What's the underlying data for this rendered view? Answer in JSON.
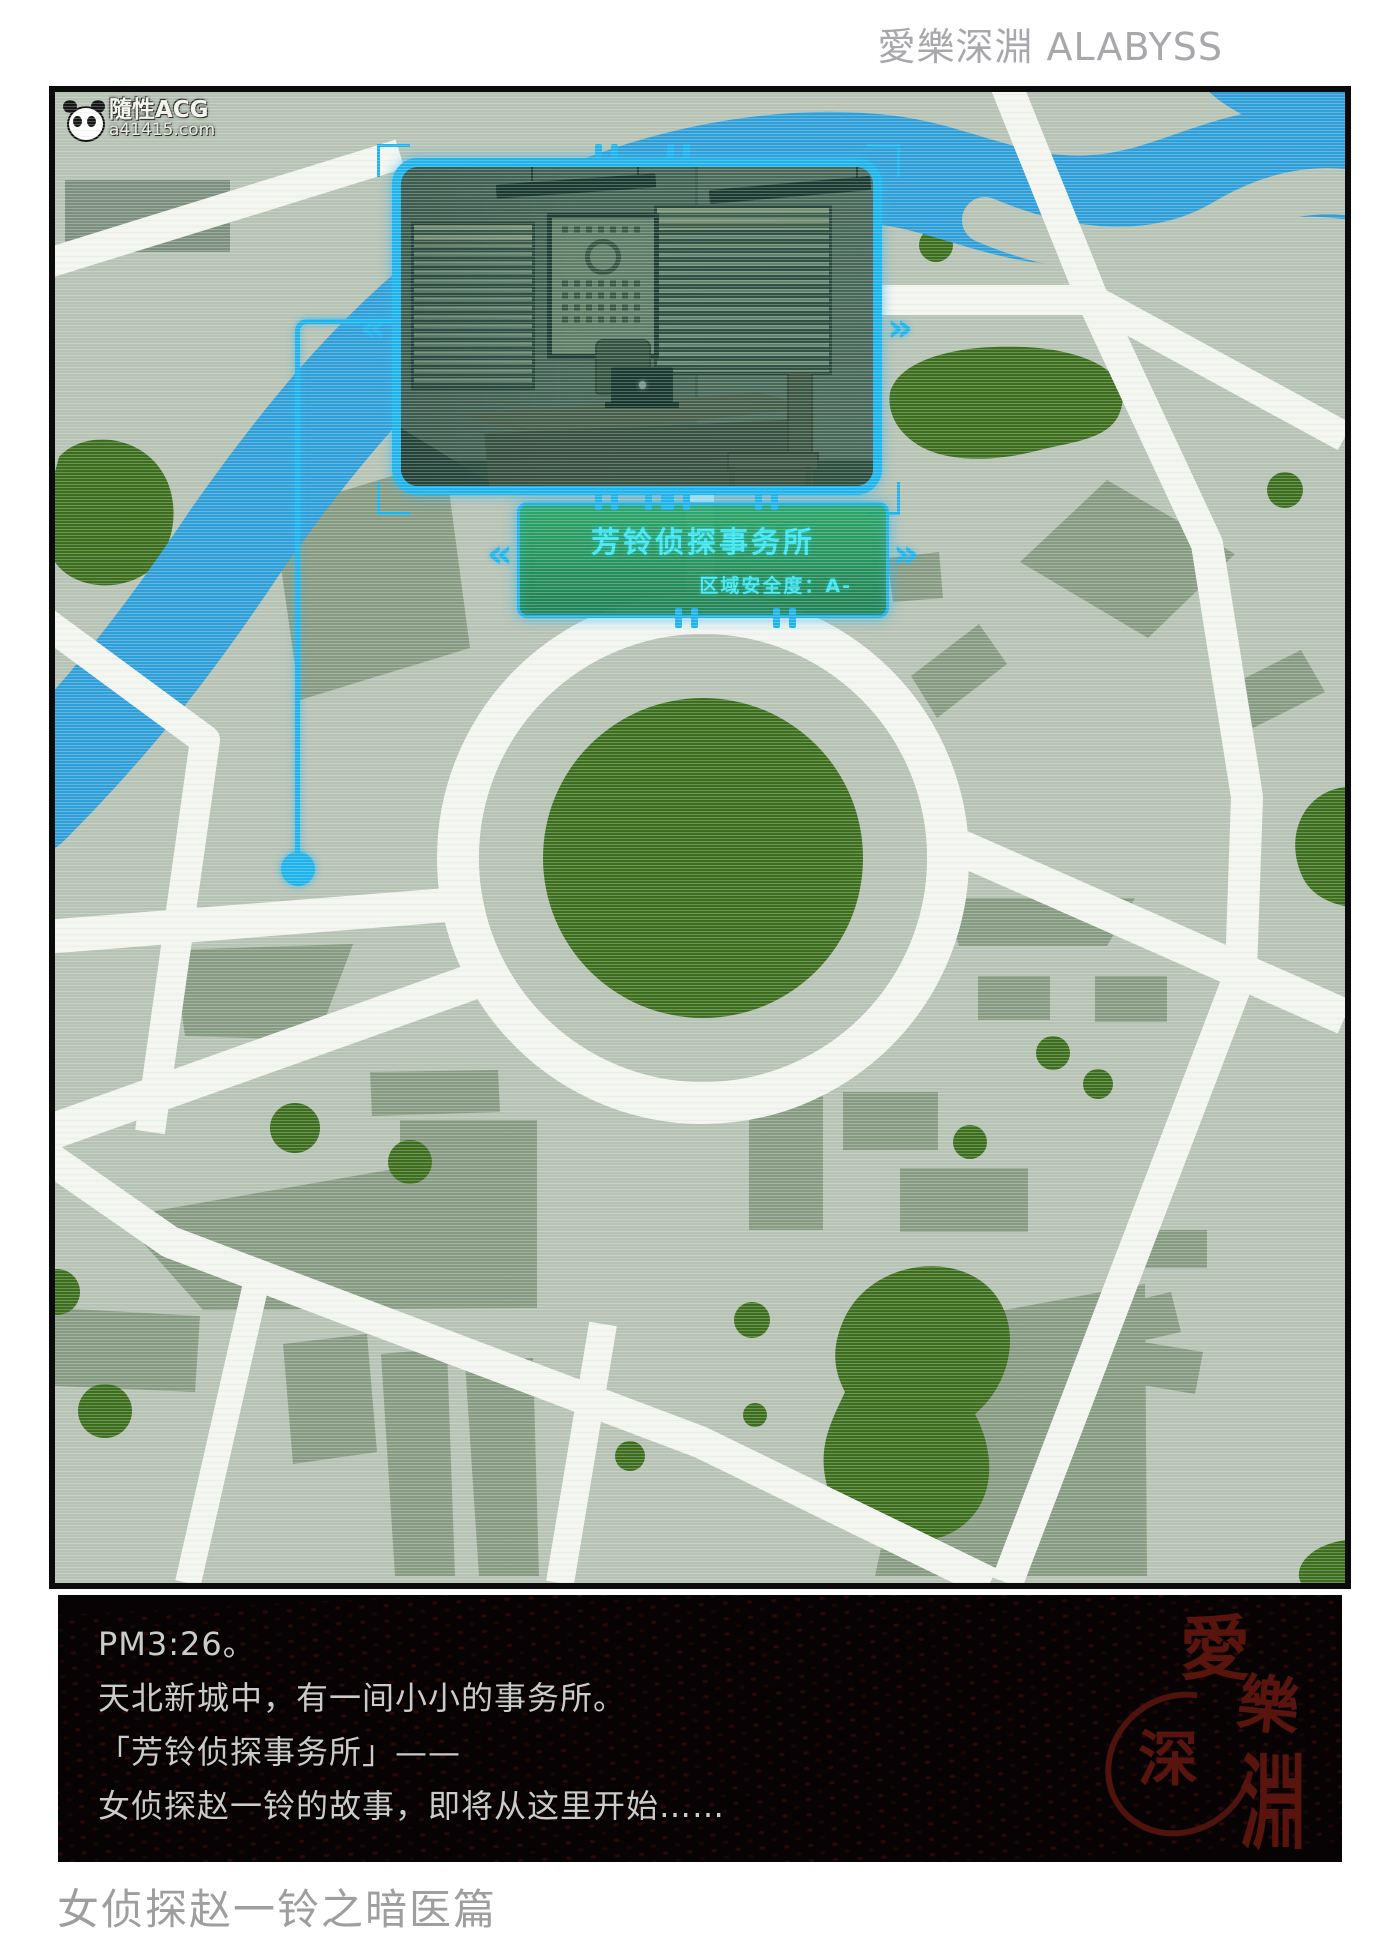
{
  "header": {
    "brand": "愛樂深淵 ALABYSS"
  },
  "watermark": {
    "site_name": "隨性ACG",
    "site_url": "a41415.com"
  },
  "map": {
    "callout": {
      "title": "芳铃侦探事务所",
      "safety_label": "区域安全度：A-"
    },
    "marker": {
      "shape": "circle",
      "color": "#1db4ee"
    },
    "colors": {
      "accent_cyan": "#1db4ee",
      "label_green": "#1f9c62",
      "callout_text": "#3fe6f2",
      "map_background": "#b6c2b4",
      "road_white": "#f3f5f1",
      "block_sage": "#879b83",
      "park_green": "#3c6e1d",
      "river_blue": "#2f9fd9"
    }
  },
  "narration": {
    "lines": [
      "PM3:26。",
      "天北新城中，有一间小小的事务所。",
      "「芳铃侦探事务所」——",
      "女侦探赵一铃的故事，即将从这里开始……"
    ]
  },
  "stamp": {
    "chars": [
      "愛",
      "樂",
      "深",
      "淵"
    ]
  },
  "footer": {
    "series_title": "女侦探赵一铃之暗医篇"
  }
}
